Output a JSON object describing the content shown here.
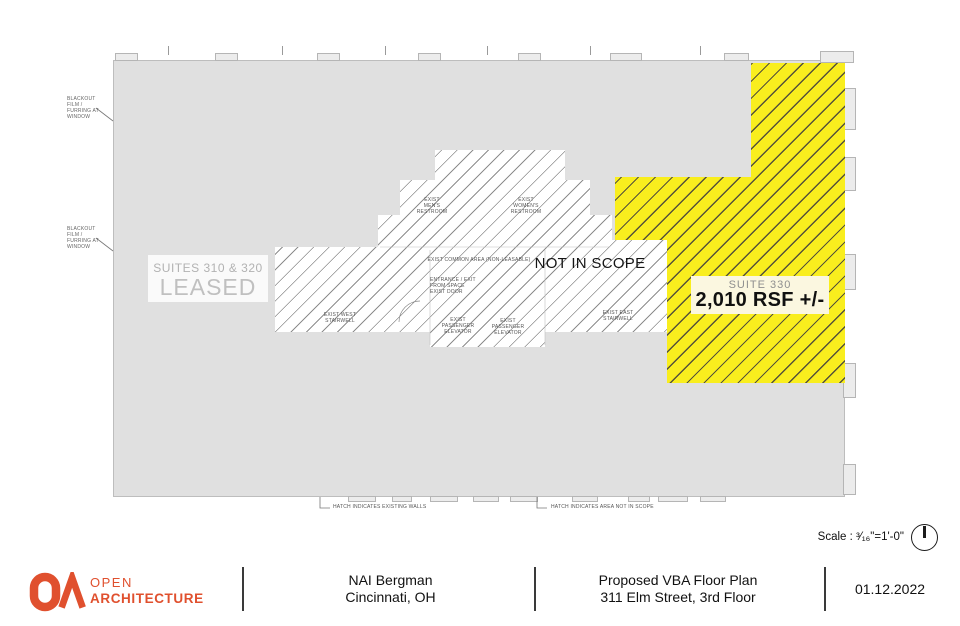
{
  "plan": {
    "suites_leased": {
      "line1": "SUITES 310 & 320",
      "line2": "LEASED"
    },
    "not_in_scope": "NOT IN SCOPE",
    "suite330": {
      "name": "SUITE 330",
      "area": "2,010 RSF +/-"
    },
    "blackout_label": [
      "BLACKOUT",
      "FILM /",
      "FURRING AT",
      "WINDOW"
    ],
    "rooms": {
      "mens": [
        "EXIST",
        "MEN'S",
        "RESTROOM"
      ],
      "womens": [
        "EXIST",
        "WOMEN'S",
        "RESTROOM"
      ],
      "common": [
        "EXIST COMMON AREA (NON-LEASABLE)"
      ],
      "entrance": [
        "ENTRANCE / EXIT",
        "FROM SPACE",
        "EXIST DOOR"
      ],
      "west_stair": [
        "EXIST WEST",
        "STAIRWELL"
      ],
      "elevator": [
        "EXIST",
        "PASSENGER",
        "ELEVATOR"
      ],
      "east_stair": [
        "EXIST EAST",
        "STAIRWELL"
      ]
    },
    "notes": {
      "existing_walls": "HATCH INDICATES EXISTING WALLS",
      "not_in_scope": "HATCH INDICATES AREA NOT IN SCOPE"
    },
    "scale_label": "Scale : ³⁄₁₆\"=1'-0\""
  },
  "titleblock": {
    "logo": {
      "line1": "OPEN",
      "line2": "ARCHITECTURE"
    },
    "client": {
      "line1": "NAI Bergman",
      "line2": "Cincinnati, OH"
    },
    "project": {
      "line1": "Proposed VBA Floor Plan",
      "line2": "311 Elm Street, 3rd Floor"
    },
    "date": "01.12.2022"
  },
  "colors": {
    "suite_highlight": "#f9ee1e",
    "building_fill": "#e0e0e0",
    "brand_orange": "#e0502e"
  }
}
